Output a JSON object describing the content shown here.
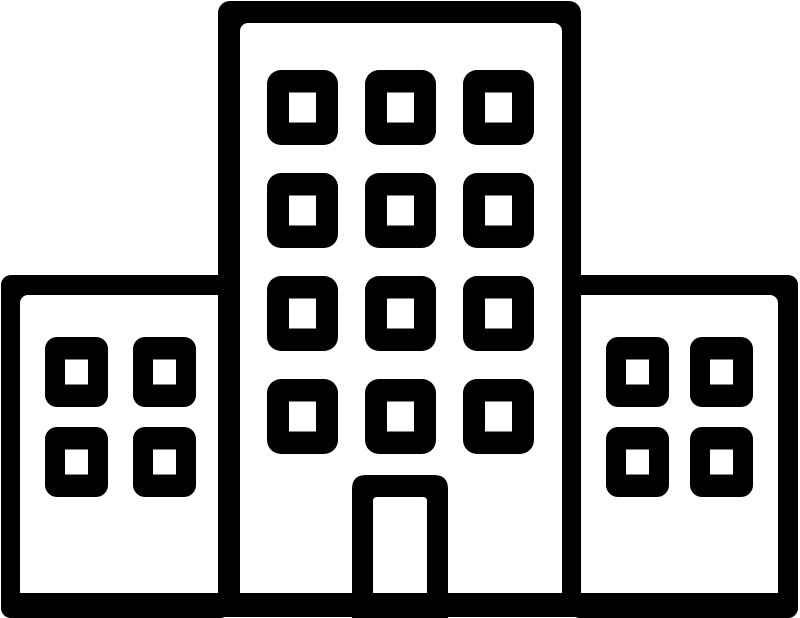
{
  "page": {
    "background_color": "#ffffff",
    "width": 800,
    "height": 618
  },
  "icon": {
    "name": "building-complex-icon",
    "description": "Black outline pictogram of a building complex: a tall central building with twelve square windows and a central doorway, flanked by two shorter side buildings with four square windows each, all standing on a single ground line.",
    "stroke_color": "#000000",
    "fill_color": "#ffffff",
    "central_building": {
      "window_rows": 4,
      "window_cols": 3,
      "has_door": true
    },
    "left_building": {
      "window_rows": 2,
      "window_cols": 2
    },
    "right_building": {
      "window_rows": 2,
      "window_cols": 2
    },
    "ground_line": true
  }
}
